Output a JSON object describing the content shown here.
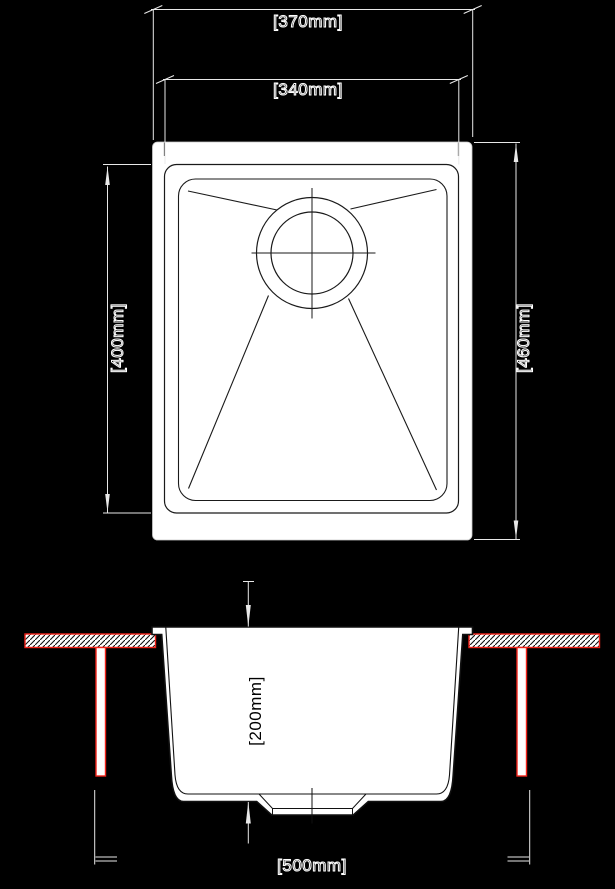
{
  "drawing": {
    "type": "technical-drawing",
    "subject": "undermount kitchen sink - plan view and installation section",
    "colors": {
      "background": "#000000",
      "linework_light": "#e8e8e8",
      "linework_dark": "#1a1a1a",
      "sink_fill": "#ffffff",
      "accent_red": "#f2231a"
    },
    "plan_view": {
      "dimensions": {
        "outer_width": "[370mm]",
        "bowl_width": "[340mm]",
        "bowl_length": "[400mm]",
        "outer_length": "[460mm]"
      }
    },
    "section_view": {
      "dimensions": {
        "bowl_depth": "[200mm]",
        "cabinet_width": "[500mm]"
      }
    }
  }
}
